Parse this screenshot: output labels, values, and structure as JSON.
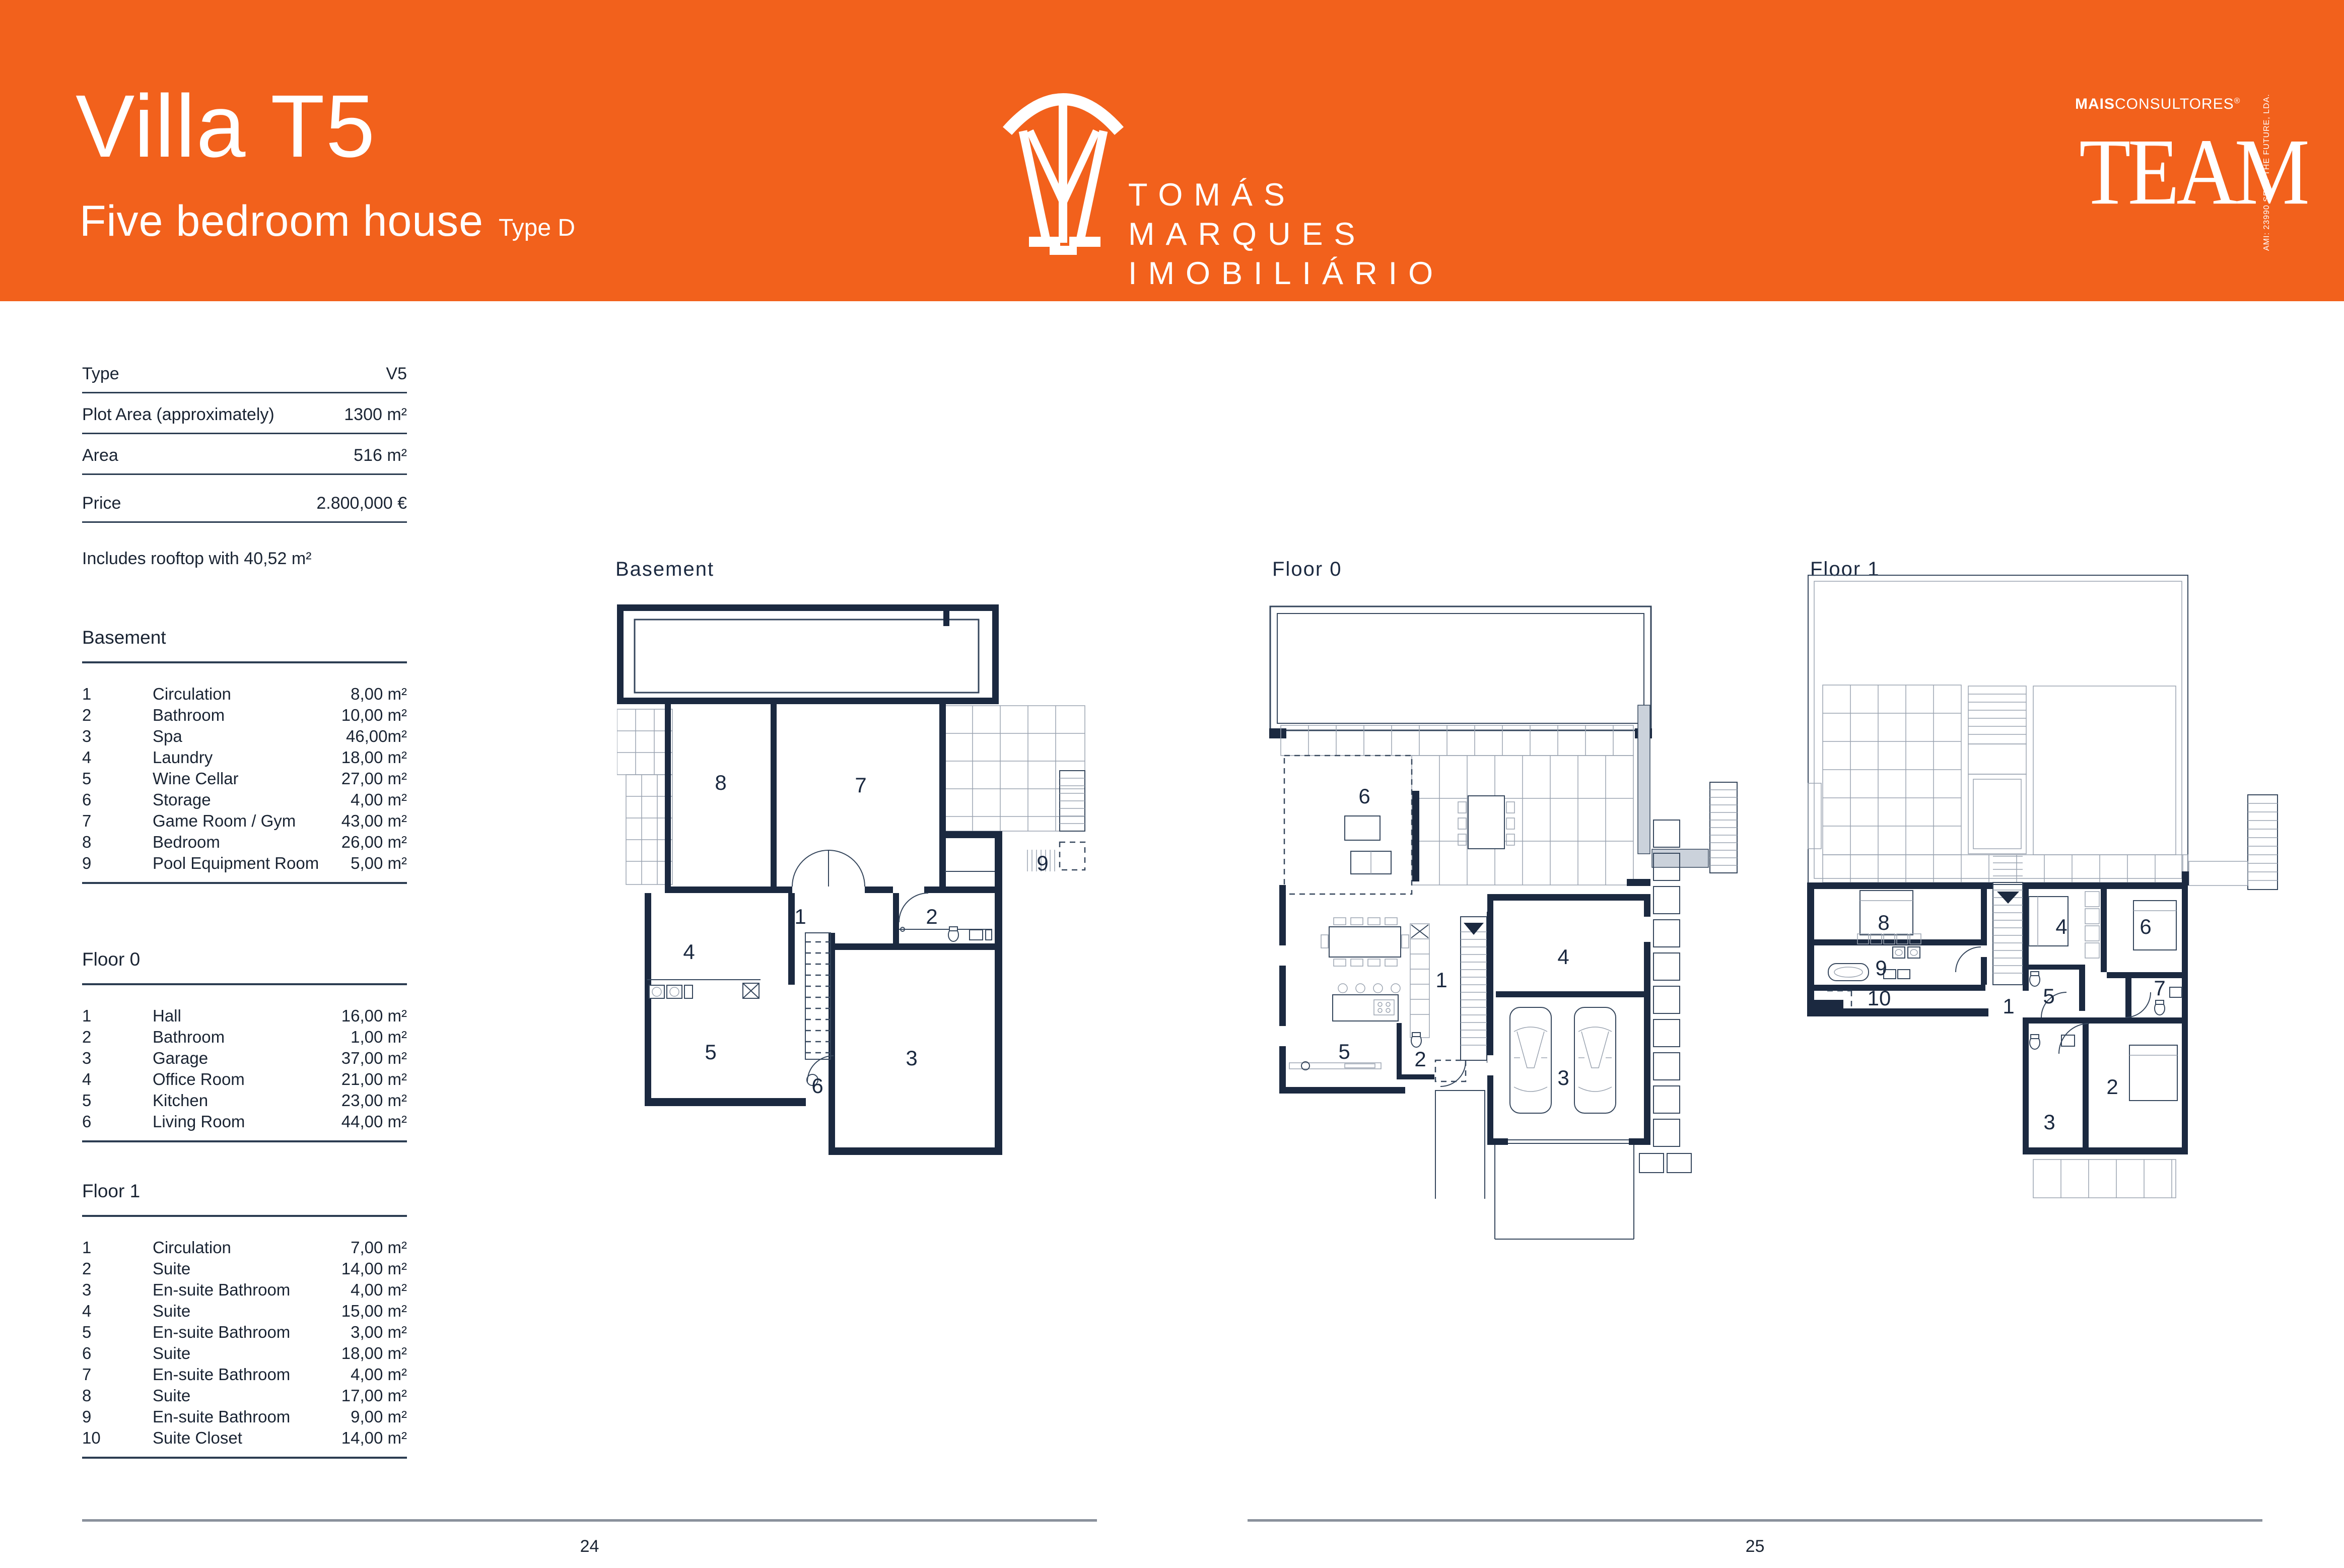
{
  "header": {
    "title": "Villa T5",
    "subtitle": "Five bedroom house",
    "type_label": "Type D",
    "brand": {
      "line1": "TOMÁS",
      "line2": "MARQUES",
      "line3": "IMOBILIÁRIO"
    },
    "partner": {
      "mais": "MAIS",
      "consultores": "CONSULTORES",
      "reg": "®",
      "wordmark": "TEAM",
      "vertical_text": "AMI: 23990  SEED THE FUTURE, LDA."
    }
  },
  "details": {
    "rows": [
      {
        "label": "Type",
        "value": "V5"
      },
      {
        "label": "Plot Area (approximately)",
        "value": "1300 m²"
      },
      {
        "label": "Area",
        "value": "516 m²"
      },
      {
        "label": "Price",
        "value": "2.800,000 €"
      }
    ],
    "note": "Includes rooftop with 40,52 m²"
  },
  "room_lists": [
    {
      "title": "Basement",
      "rows": [
        {
          "num": "1",
          "name": "Circulation",
          "area": "8,00 m²"
        },
        {
          "num": "2",
          "name": "Bathroom",
          "area": "10,00 m²"
        },
        {
          "num": "3",
          "name": "Spa",
          "area": "46,00m²"
        },
        {
          "num": "4",
          "name": "Laundry",
          "area": "18,00 m²"
        },
        {
          "num": "5",
          "name": "Wine Cellar",
          "area": "27,00 m²"
        },
        {
          "num": "6",
          "name": "Storage",
          "area": "4,00 m²"
        },
        {
          "num": "7",
          "name": "Game Room / Gym",
          "area": "43,00 m²"
        },
        {
          "num": "8",
          "name": "Bedroom",
          "area": "26,00 m²"
        },
        {
          "num": "9",
          "name": "Pool Equipment Room",
          "area": "5,00 m²"
        }
      ]
    },
    {
      "title": "Floor 0",
      "rows": [
        {
          "num": "1",
          "name": "Hall",
          "area": "16,00 m²"
        },
        {
          "num": "2",
          "name": "Bathroom",
          "area": "1,00 m²"
        },
        {
          "num": "3",
          "name": "Garage",
          "area": "37,00 m²"
        },
        {
          "num": "4",
          "name": "Office Room",
          "area": "21,00 m²"
        },
        {
          "num": "5",
          "name": "Kitchen",
          "area": "23,00 m²"
        },
        {
          "num": "6",
          "name": "Living Room",
          "area": "44,00 m²"
        }
      ]
    },
    {
      "title": "Floor 1",
      "rows": [
        {
          "num": "1",
          "name": "Circulation",
          "area": "7,00 m²"
        },
        {
          "num": "2",
          "name": "Suite",
          "area": "14,00 m²"
        },
        {
          "num": "3",
          "name": "En-suite Bathroom",
          "area": "4,00 m²"
        },
        {
          "num": "4",
          "name": "Suite",
          "area": "15,00 m²"
        },
        {
          "num": "5",
          "name": "En-suite Bathroom",
          "area": "3,00 m²"
        },
        {
          "num": "6",
          "name": "Suite",
          "area": "18,00 m²"
        },
        {
          "num": "7",
          "name": "En-suite Bathroom",
          "area": "4,00 m²"
        },
        {
          "num": "8",
          "name": "Suite",
          "area": "17,00 m²"
        },
        {
          "num": "9",
          "name": "En-suite Bathroom",
          "area": "9,00 m²"
        },
        {
          "num": "10",
          "name": "Suite Closet",
          "area": "14,00 m²"
        }
      ]
    }
  ],
  "plans": {
    "basement": {
      "label": "Basement",
      "numbers": {
        "n8": "8",
        "n7": "7",
        "n9": "9",
        "n1": "1",
        "n2": "2",
        "n4": "4",
        "n5": "5",
        "n6": "6",
        "n3": "3"
      }
    },
    "floor0": {
      "label": "Floor 0",
      "numbers": {
        "n6": "6",
        "n4": "4",
        "n1": "1",
        "n5": "5",
        "n2": "2",
        "n3": "3"
      }
    },
    "floor1": {
      "label": "Floor 1",
      "numbers": {
        "n8": "8",
        "n9": "9",
        "n10": "10",
        "n1": "1",
        "n4": "4",
        "n5": "5",
        "n6": "6",
        "n7": "7",
        "n2": "2",
        "n3": "3"
      }
    }
  },
  "footer": {
    "left_page": "24",
    "right_page": "25"
  },
  "colors": {
    "accent": "#F2611C",
    "wall": "#1B2940",
    "rule_dark": "#2C3D52",
    "rule_gray": "#8A919C"
  }
}
